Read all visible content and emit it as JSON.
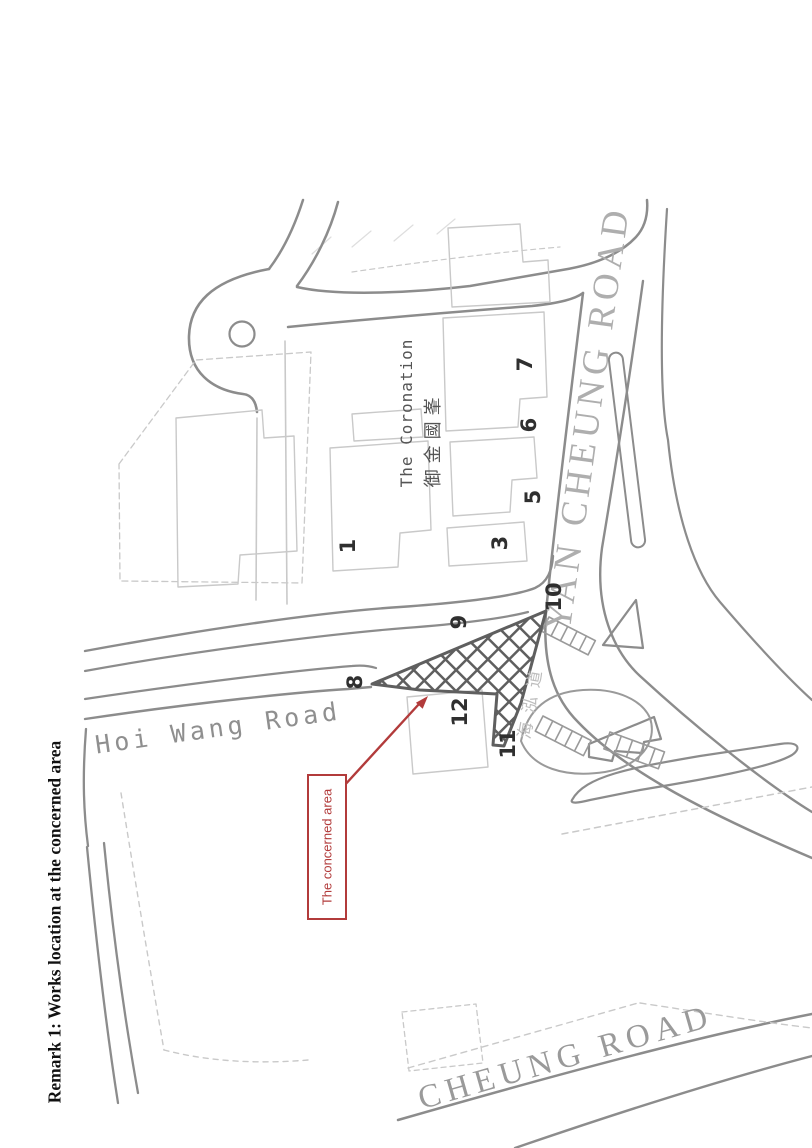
{
  "document": {
    "remark_title": "Remark 1: Works location at the concerned area"
  },
  "map": {
    "estate": {
      "name_en": "The Coronation",
      "name_zh": "御金國峯"
    },
    "roads": {
      "hoi_wang": "Hoi Wang Road",
      "yan_cheung": "YAN CHEUNG ROAD",
      "cheung": "CHEUNG ROAD",
      "hoi_wang_zh": "海泓道"
    },
    "location_markers": [
      "1",
      "3",
      "5",
      "6",
      "7",
      "8",
      "9",
      "10",
      "11",
      "12"
    ],
    "annotation": {
      "label": "The concerned area",
      "color": "#b23b3b"
    },
    "colors": {
      "road_line": "#8c8c8c",
      "light_line": "#c9c9c9",
      "hatch": "#5f5f5f"
    }
  }
}
